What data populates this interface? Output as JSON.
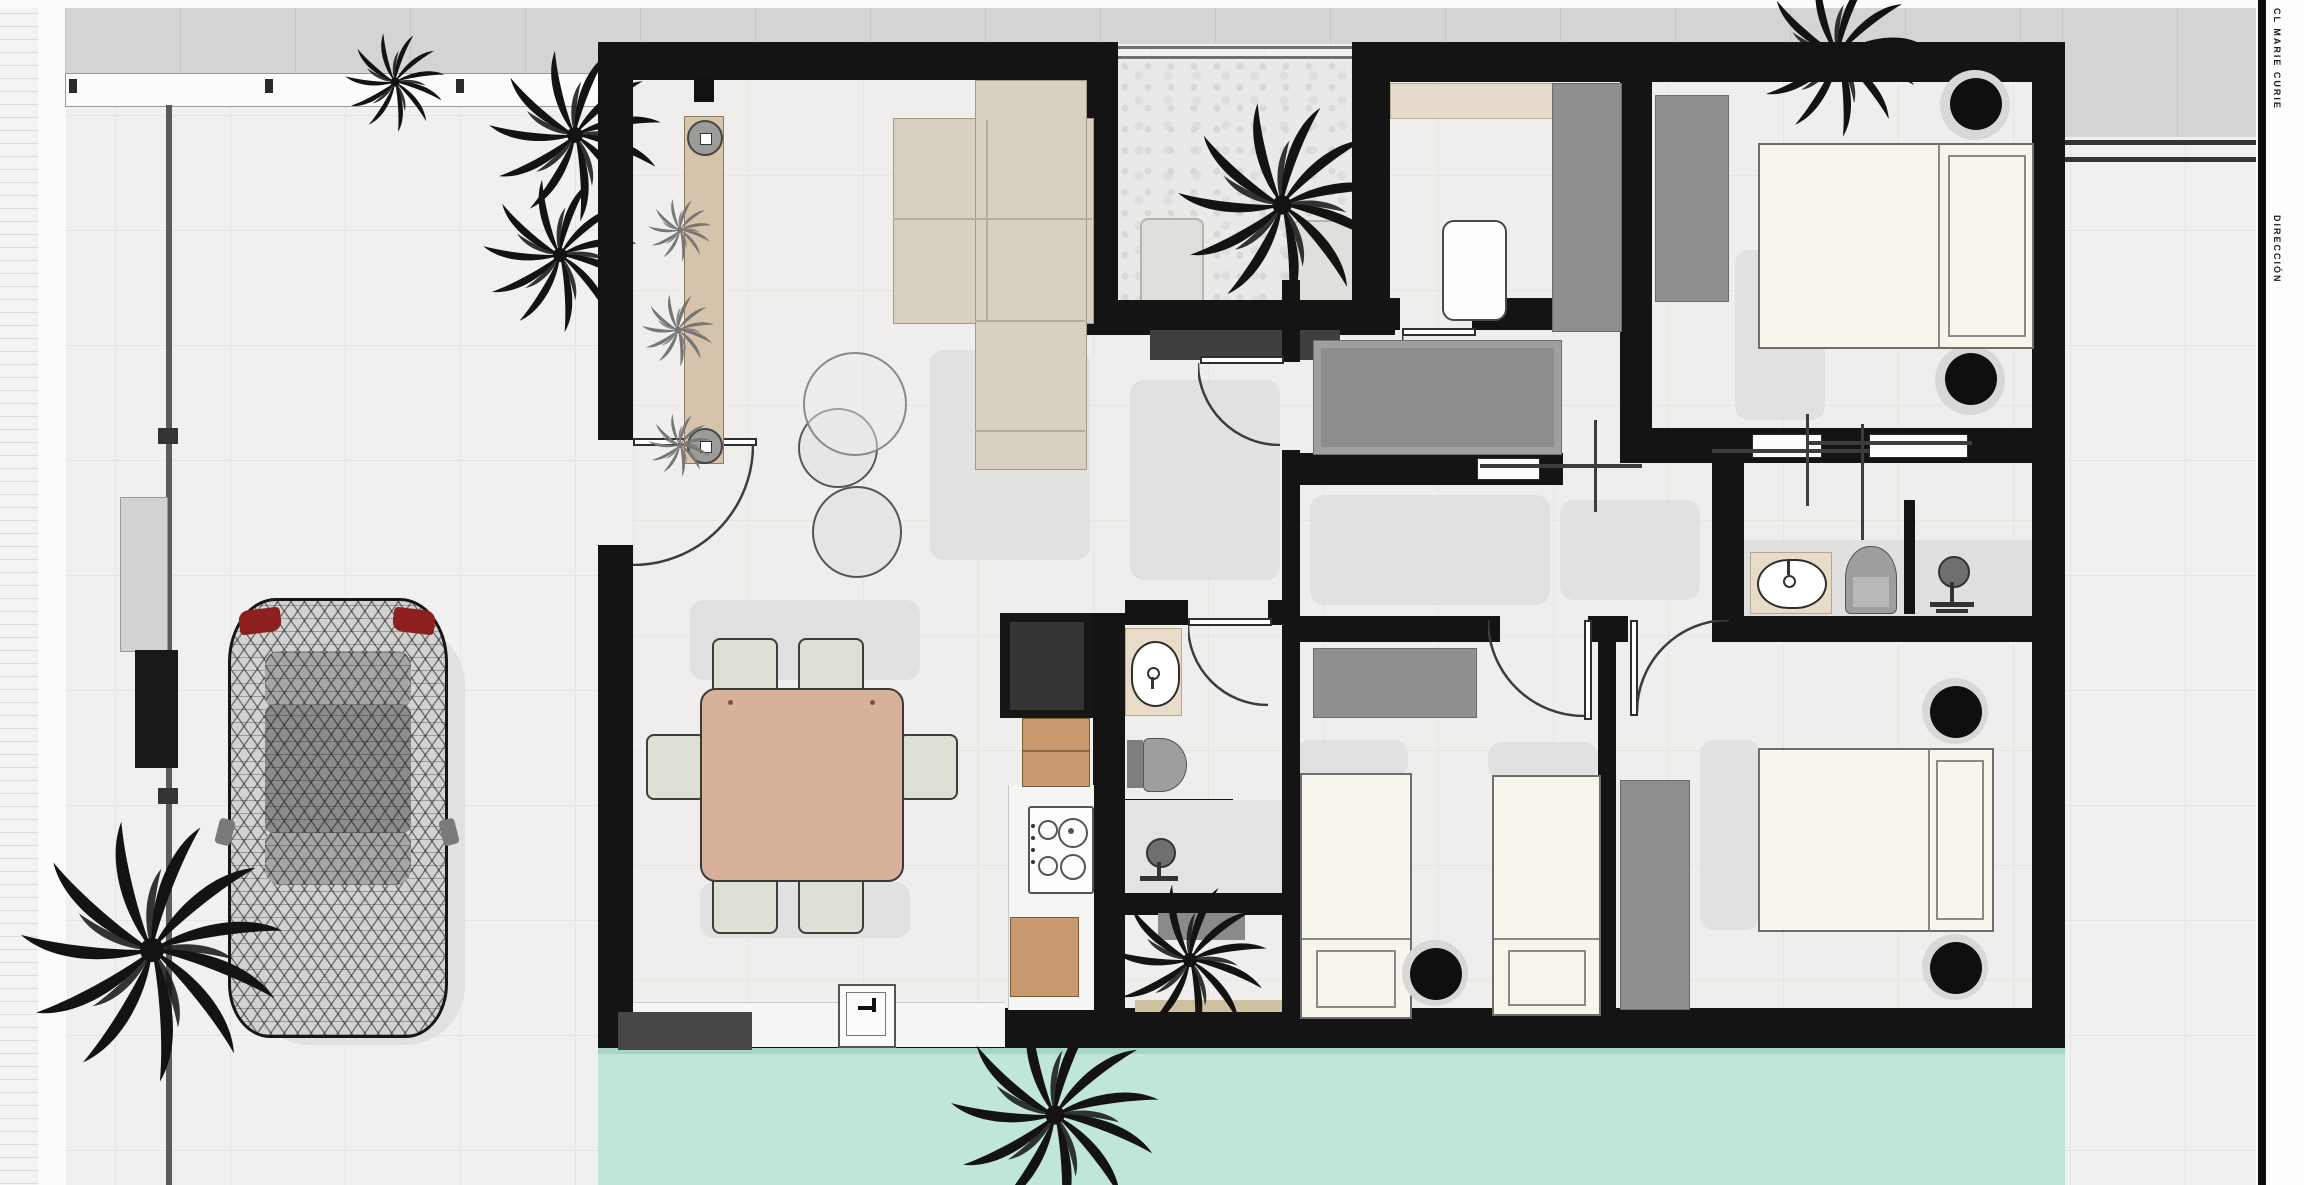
{
  "sheet": {
    "side_label_1": "CL MARIE CURIE",
    "side_label_2": "DIRECCIÓN"
  },
  "colors": {
    "wall": "#141414",
    "floor": "#efeeec",
    "outdoor": "#f0f0ee",
    "road": "#d4d4d2",
    "pool": "#c0e5da",
    "pool_edge": "#a6d4c7",
    "sofa": "#d8d1c2",
    "dining_table": "#d8b19a",
    "chair": "#dde0d4",
    "wood": "#c8996e",
    "vanity": "#e8dcc9",
    "wardrobe": "#8f8f8d",
    "closet": "#9f9f9d",
    "bed": "#f8f5ec",
    "plant": "#131311",
    "agave": "#767674",
    "mat": "#474745",
    "taillight": "#8e1f1f"
  },
  "plan": {
    "rooms": [
      {
        "name": "living-dining",
        "furniture": [
          "sectional-sofa",
          "tv-console",
          "dining-table",
          "six-chairs",
          "two-poufs",
          "pendant-lamp"
        ]
      },
      {
        "name": "kitchen",
        "furniture": [
          "fridge",
          "wood-cabinet",
          "gas-hob",
          "counter",
          "kitchen-sink"
        ]
      },
      {
        "name": "patio-courtyard",
        "furniture": [
          "palm-tree",
          "two-loungers",
          "glass-front"
        ]
      },
      {
        "name": "laundry-office",
        "furniture": [
          "shelf",
          "white-table",
          "wardrobe"
        ]
      },
      {
        "name": "bedroom-1",
        "furniture": [
          "double-bed",
          "wardrobe",
          "two-side-tables",
          "sliding-doors"
        ]
      },
      {
        "name": "bathroom-1",
        "furniture": [
          "vanity-sink",
          "toilet",
          "shower"
        ]
      },
      {
        "name": "bathroom-2",
        "furniture": [
          "vanity-sink",
          "toilet",
          "shower",
          "half-wall"
        ]
      },
      {
        "name": "bedroom-2",
        "furniture": [
          "two-single-beds",
          "wardrobe",
          "round-side-table"
        ]
      },
      {
        "name": "master-bedroom",
        "furniture": [
          "double-bed",
          "wardrobe",
          "two-side-tables"
        ]
      },
      {
        "name": "hallway",
        "furniture": [
          "built-in-closet",
          "sliding-door"
        ]
      }
    ],
    "outdoor_features": [
      "street",
      "fence",
      "driveway",
      "wireframe-car",
      "palm-trees",
      "agave-plants",
      "swimming-pool",
      "tiled-walkway"
    ]
  }
}
